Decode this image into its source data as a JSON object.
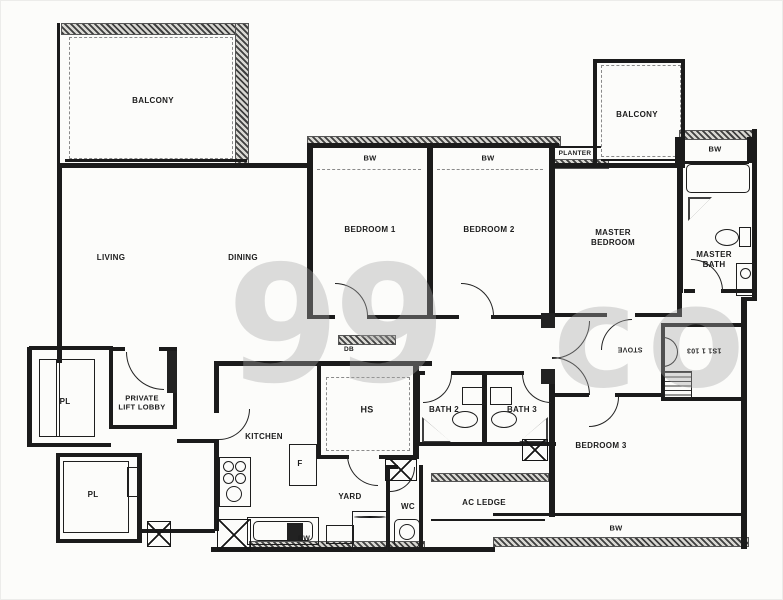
{
  "plan": {
    "type": "residential floor plan (scanned)",
    "rooms": {
      "balcony_tl": "BALCONY",
      "balcony_tr": "BALCONY",
      "living": "LIVING",
      "dining": "DINING",
      "bedroom1": "BEDROOM 1",
      "bedroom2": "BEDROOM 2",
      "bedroom3": "BEDROOM 3",
      "master_bedroom": "MASTER BEDROOM",
      "master_bath": "MASTER BATH",
      "bath2": "BATH 2",
      "bath3": "BATH 3",
      "kitchen": "KITCHEN",
      "yard": "YARD",
      "wc": "WC",
      "hs": "HS",
      "ac_ledge": "AC LEDGE",
      "planter": "PLANTER",
      "private_lift_lobby": "PRIVATE LIFT LOBBY",
      "pl_upper": "PL",
      "pl_lower": "PL"
    },
    "markers": {
      "bw_bedroom1": "BW",
      "bw_bedroom2": "BW",
      "bw_master": "BW",
      "bw_bedroom3": "BW",
      "bw_kitchen": "BW",
      "db": "DB",
      "fridge": "F"
    },
    "adjacent_upside_down_labels": {
      "stove": "STOVE",
      "store_number": "1S1 1 103"
    },
    "watermark": {
      "left": "99",
      "right": "co"
    },
    "icons": [
      "stove-burners-icon",
      "cooker-hood-fan-icon",
      "kitchen-sink-icon",
      "washing-machine-icon",
      "toilet-icon",
      "wash-basin-icon",
      "bathtub-icon",
      "shower-screen-icon",
      "lift-shaft-icon",
      "ac-riser-xbox-icon",
      "door-swing-arc-icon",
      "bay-window-hatch-icon"
    ],
    "colors": {
      "wall": "#1b1b1b",
      "paper": "#fcfcfa",
      "watermark": "#a8a8a8",
      "hatch_dark": "#3f3f3f"
    }
  }
}
